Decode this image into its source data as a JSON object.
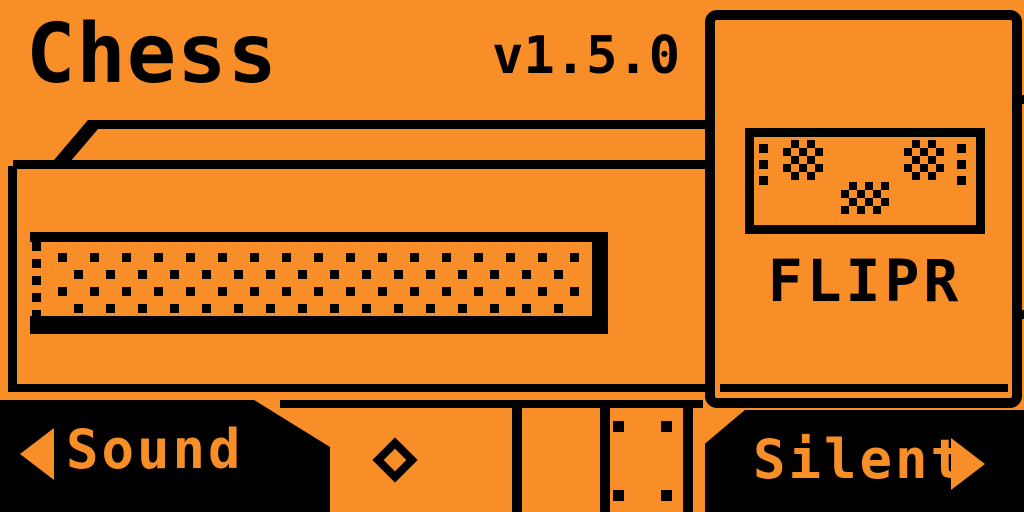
{
  "screen": {
    "background": "#F88E28",
    "ink": "#000000"
  },
  "header": {
    "title": "Chess",
    "version": "v1.5.0"
  },
  "carousel_card": {
    "label": "FLIPR"
  },
  "footer": {
    "left_button": "Sound",
    "right_button": "Silent",
    "icons": [
      "arrow-left-icon",
      "ok-diamond-icon",
      "arrow-right-icon"
    ]
  }
}
